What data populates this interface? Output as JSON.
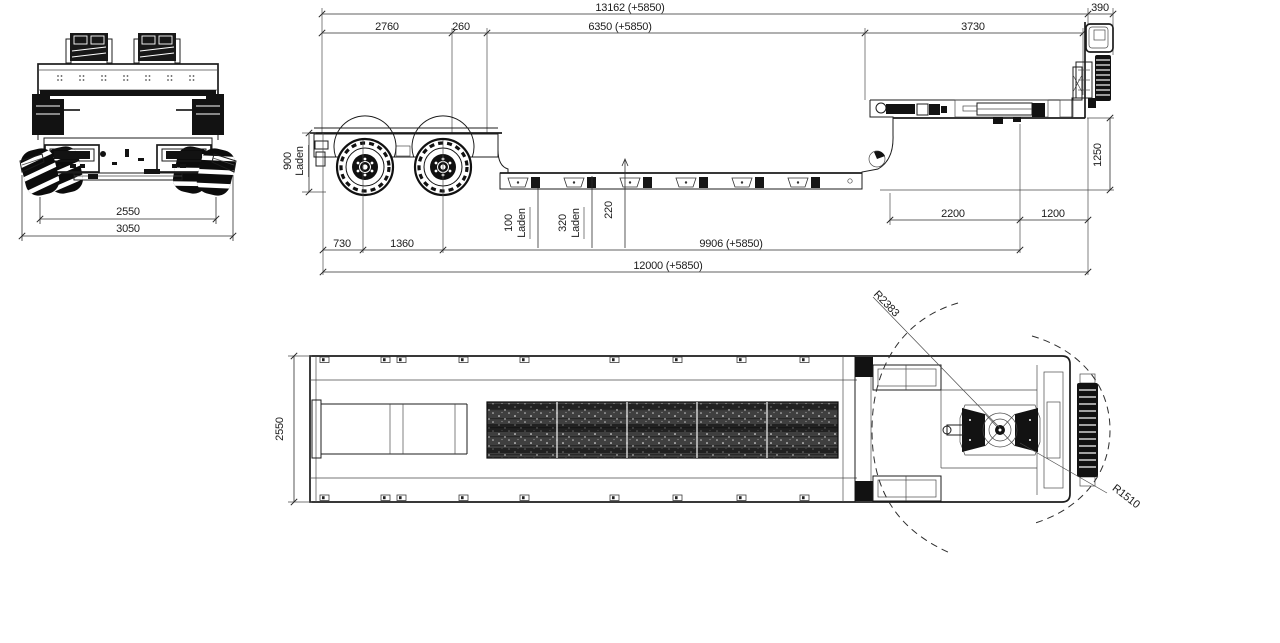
{
  "drawing": {
    "background": "#ffffff",
    "line_color": "#1c1c1c"
  },
  "rear_view": {
    "track_width": "2550",
    "overall_width": "3050"
  },
  "side_view": {
    "total_with_extension": "13162 (+5850)",
    "front_overhang": "390",
    "rear_deck_length": "2760",
    "gap": "260",
    "well_length": "6350 (+5850)",
    "gooseneck_length": "3730",
    "rear_deck_height": "900",
    "laden": "Laden",
    "fifth_wheel_height": "1250",
    "ground_clearance": "100",
    "deck_height": "320",
    "step_height": "220",
    "rear_overhang": "730",
    "axle_spacing": "1360",
    "axle_to_kingpin": "9906 (+5850)",
    "overall_length": "12000 (+5850)",
    "gooseneck_to_kingpin": "2200",
    "kingpin_to_front": "1200"
  },
  "top_view": {
    "deck_width": "2550",
    "turning_radius_rear": "R2383",
    "turning_radius_front": "R1510"
  }
}
